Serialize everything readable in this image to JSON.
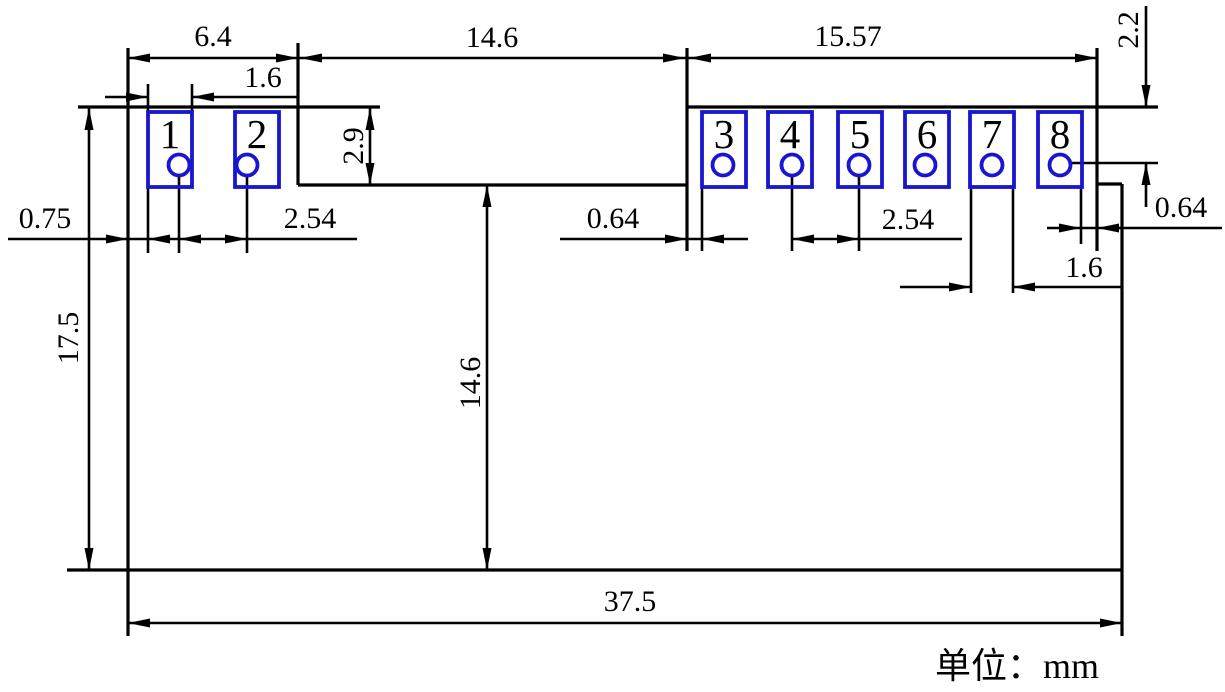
{
  "drawing": {
    "unit_note": "单位：mm",
    "pads": {
      "labels": [
        "1",
        "2",
        "3",
        "4",
        "5",
        "6",
        "7",
        "8"
      ]
    },
    "dimensions": {
      "top_left_width": "6.4",
      "notch_width": "14.6",
      "top_right_width": "15.57",
      "top_edge_to_hole_row": "2.2",
      "pad1_width": "1.6",
      "left_edge_to_pad1": "0.75",
      "left_pitch": "2.54",
      "left_section_height": "2.9",
      "notch_to_pad3": "0.64",
      "right_pitch": "2.54",
      "pad8_to_right_edge": "0.64",
      "pad7_width": "1.6",
      "body_height": "17.5",
      "notch_depth": "14.6",
      "total_width": "37.5"
    },
    "colors": {
      "line": "#000000",
      "pad_outline": "#1a15cf",
      "pad_number": "#c42127",
      "background": "#ffffff"
    }
  }
}
